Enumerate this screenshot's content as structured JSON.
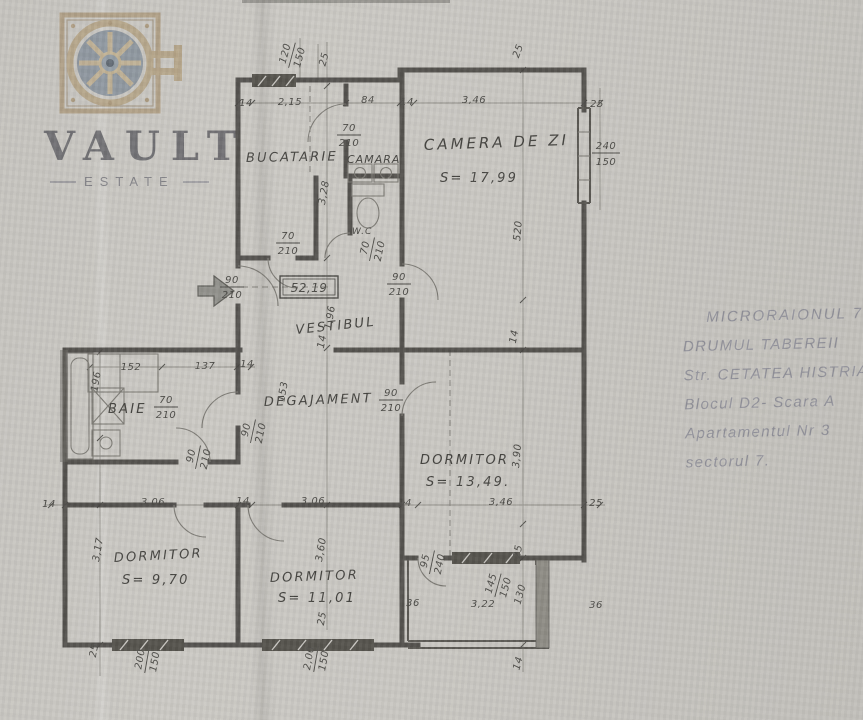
{
  "watermark": {
    "brand": "VAULT",
    "sub": "ESTATE"
  },
  "notes": {
    "lines": [
      "MICRORAIONUL 7",
      "DRUMUL TABEREII",
      "Str. CETATEA HISTRIA",
      "Blocul D2-  Scara A",
      "Apartamentul  Nr 3",
      "sectorul 7."
    ]
  },
  "plan": {
    "total_area": "52,19",
    "rooms": {
      "bucatarie": {
        "name": "BUCATARIE"
      },
      "camara": {
        "name": "CAMARA"
      },
      "camera_de_zi": {
        "name": "CAMERA DE ZI",
        "area": "S= 17,99"
      },
      "wc": {
        "name": "W.C"
      },
      "vestibul": {
        "name": "VESTIBUL"
      },
      "degajament": {
        "name": "DEGAJAMENT"
      },
      "baie": {
        "name": "BAIE"
      },
      "dormitor_1": {
        "name": "DORMITOR",
        "area": "S= 9,70"
      },
      "dormitor_2": {
        "name": "DORMITOR",
        "area": "S= 11,01"
      },
      "dormitor_3": {
        "name": "DORMITOR",
        "area": "S= 13,49."
      }
    },
    "dims": {
      "top_window": {
        "num": "120",
        "den": "150"
      },
      "top_25_left": "25",
      "top_25_right": "25",
      "top_row": [
        "14",
        "2,15",
        "84",
        "14",
        "3,46",
        "25"
      ],
      "right_window": {
        "num": "240",
        "den": "150"
      },
      "living_height": "520",
      "right_wall_14": "14",
      "kitchen_depth": "3,28",
      "camara_door": {
        "num": "70",
        "den": "210"
      },
      "kitchen_door": {
        "num": "70",
        "den": "210"
      },
      "wc_door": {
        "num": "70",
        "den": "210"
      },
      "living_door": {
        "num": "90",
        "den": "210"
      },
      "entry_door": {
        "num": "90",
        "den": "210"
      },
      "vestibul_depth": "1,96",
      "vestibul_wall": "14",
      "mid_row": [
        "152",
        "137",
        "14"
      ],
      "baie_depth": "196",
      "degajament_width": "153",
      "baie_door": {
        "num": "70",
        "den": "210"
      },
      "dorm1_door": {
        "num": "90",
        "den": "210"
      },
      "dorm2_door": {
        "num": "90",
        "den": "210"
      },
      "dorm3_door": {
        "num": "90",
        "den": "210"
      },
      "dorm3_depth": "3,90",
      "bottom_row": [
        "14",
        "3,06",
        "14",
        "3,06",
        "14",
        "3,46",
        "25"
      ],
      "dorm1_depth": "3,17",
      "dorm2_depth": "3,60",
      "dorm1_wall_25": "25",
      "dorm2_wall_25": "25",
      "dorm1_window": {
        "num": "200",
        "den": "150"
      },
      "dorm2_window": {
        "num": "2,00",
        "den": "150"
      },
      "balcony_door": {
        "num": "95",
        "den": "240"
      },
      "balcony_25": "25",
      "balcony_window": {
        "num": "145",
        "den": "150"
      },
      "balcony_depth": "130",
      "balcony_width": "3,22",
      "balcony_36_left": "36",
      "balcony_36_right": "36",
      "balcony_14": "14"
    }
  }
}
